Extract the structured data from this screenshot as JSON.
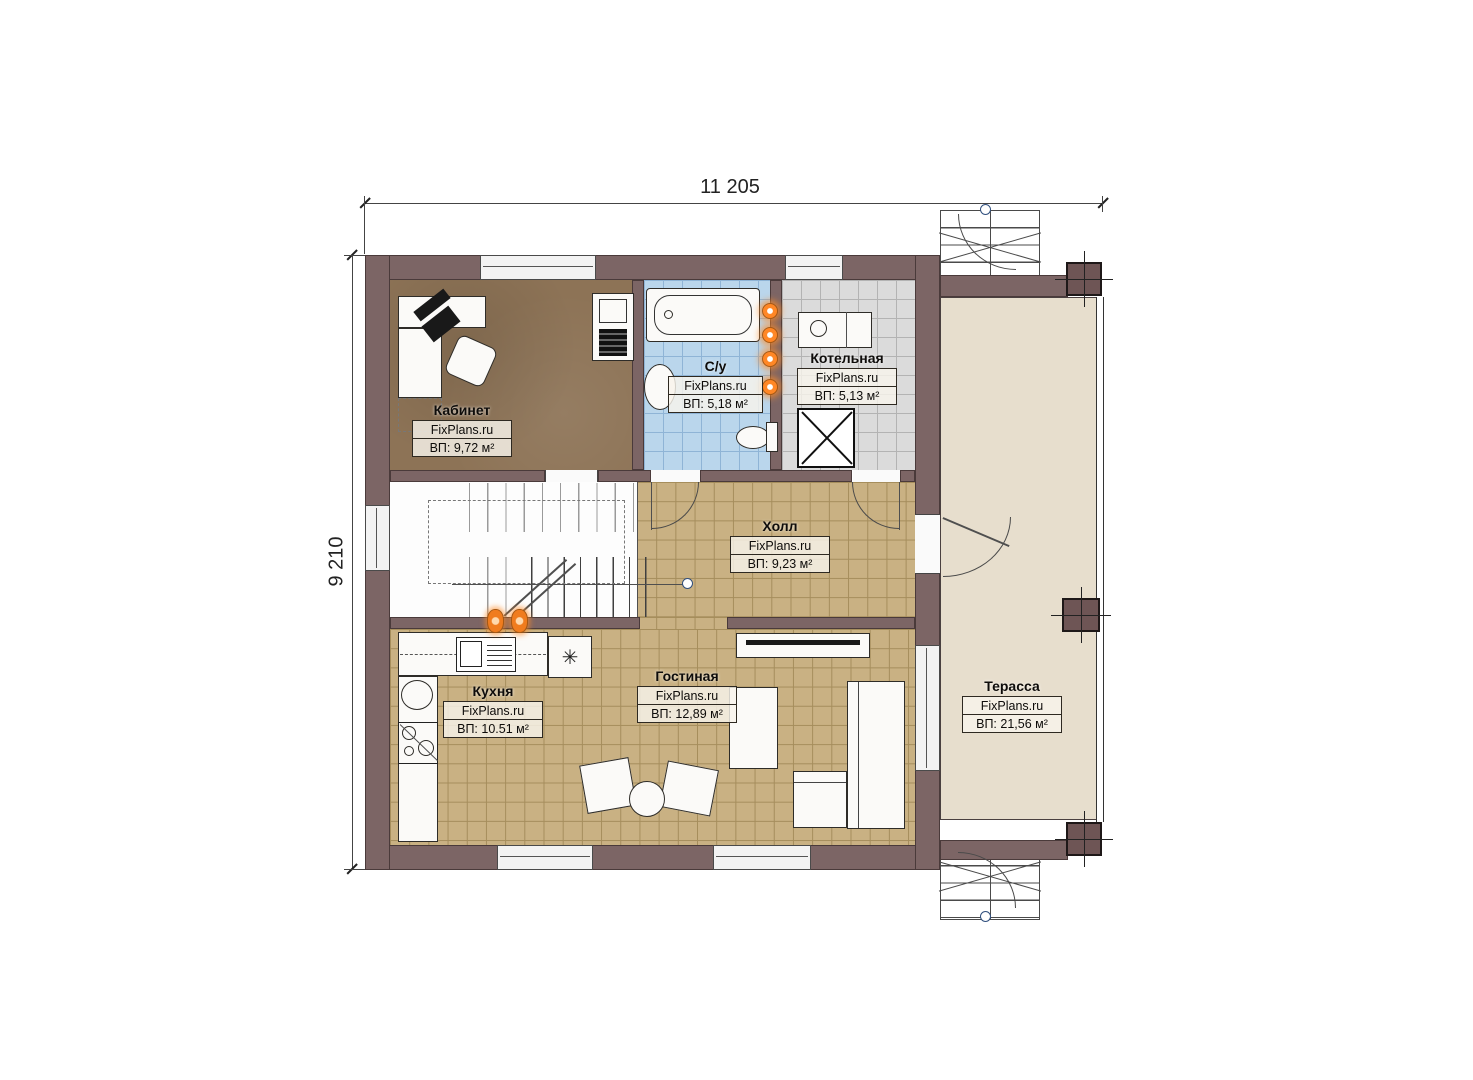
{
  "watermark": "FixPlans.ru",
  "dimensions": {
    "top": "11 205",
    "left": "9 210"
  },
  "rooms": {
    "kabinet": {
      "name": "Кабинет",
      "area": "ВП: 9,72 м²"
    },
    "su": {
      "name": "С/у",
      "area": "ВП: 5,18 м²"
    },
    "kotelnaya": {
      "name": "Котельная",
      "area": "ВП: 5,13 м²"
    },
    "holl": {
      "name": "Холл",
      "area": "ВП: 9,23 м²"
    },
    "kuhnya": {
      "name": "Кухня",
      "area": "ВП: 10.51 м²"
    },
    "gostinaya": {
      "name": "Гостиная",
      "area": "ВП: 12,89 м²"
    },
    "terassa": {
      "name": "Терасса",
      "area": "ВП: 21,56 м²"
    }
  },
  "icons": {
    "fridge": "✳"
  },
  "colors": {
    "wall": "#7c6565",
    "office_floor": "#8d7356",
    "bath_floor": "#bad6ec",
    "boiler_floor": "#dbdbdb",
    "tile_floor": "#c9b183",
    "terrace_floor": "#e7decd",
    "accent_orange": "#f07c1e"
  }
}
